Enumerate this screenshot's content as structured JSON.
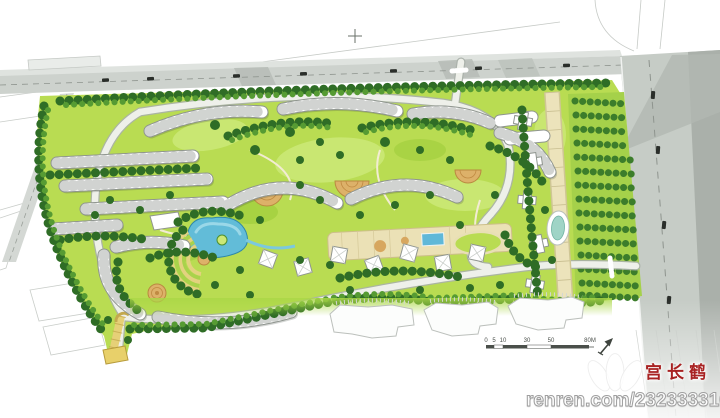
{
  "watermark": {
    "logo_name": "renren-three-petal-logo",
    "author_text": "宫长鹤",
    "author_color": "#a82222",
    "url_text": "renren.com/232333316"
  },
  "scale_bar": {
    "labels": [
      "0",
      "5",
      "10",
      "30",
      "50",
      "80M"
    ]
  },
  "north_arrow": {
    "name": "north-arrow"
  },
  "palette": {
    "site_green": "#b9dc52",
    "lawn_light": "#cbe876",
    "tree_dark": "#2f6d26",
    "tree_mid": "#569b33",
    "road_gray": "#cbd0cb",
    "road_dark": "#a9afa9",
    "building_white": "#ffffff",
    "plaza_tan": "#ddb169",
    "axis_cream": "#ebe1b6",
    "water_blue": "#62bcd8",
    "gate_yellow": "#e8d06a"
  }
}
